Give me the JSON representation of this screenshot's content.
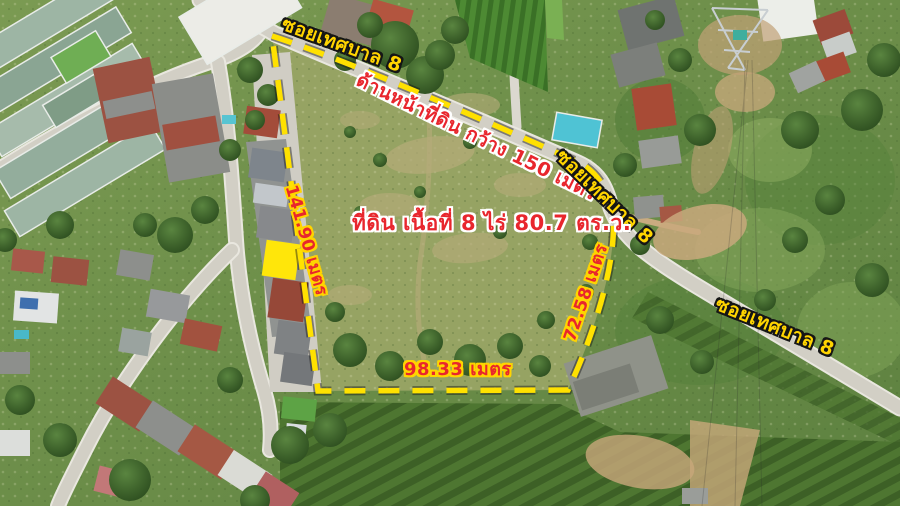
{
  "image_type": "annotated aerial photo of a land plot for sale",
  "road_name": "ซอยเทศบาล 8",
  "annotations": {
    "road_label_top": "ซอยเทศบาล 8",
    "road_label_mid": "ซอยเทศบาล 8",
    "road_label_right": "ซอยเทศบาล 8",
    "frontage_label": "ด้านหน้าที่ดิน กว้าง 150 เมตร",
    "area_label": "ที่ดิน เนื้อที่ 8 ไร่ 80.7 ตร.ว.",
    "side_left_label": "141.90 เมตร",
    "side_right_label": "72.58 เมตร",
    "side_bottom_label": "98.33 เมตร"
  },
  "measurements": {
    "frontage_m": 150,
    "side_left_m": 141.9,
    "side_right_m": 72.58,
    "side_bottom_m": 98.33,
    "area_rai": 8,
    "area_sq_wah": 80.7
  },
  "colors": {
    "boundary_dash": "#ffe100",
    "road_label_fill": "#ffd400",
    "road_label_outline": "#151515",
    "measure_fill": "#e8262d",
    "measure_outline": "#ffd400",
    "info_fill": "#e8262d",
    "info_outline": "#ffffff",
    "highlighted_unit": "#ffe60a",
    "road_surface": "#d2cfc5",
    "field_grass": "#96a363"
  }
}
